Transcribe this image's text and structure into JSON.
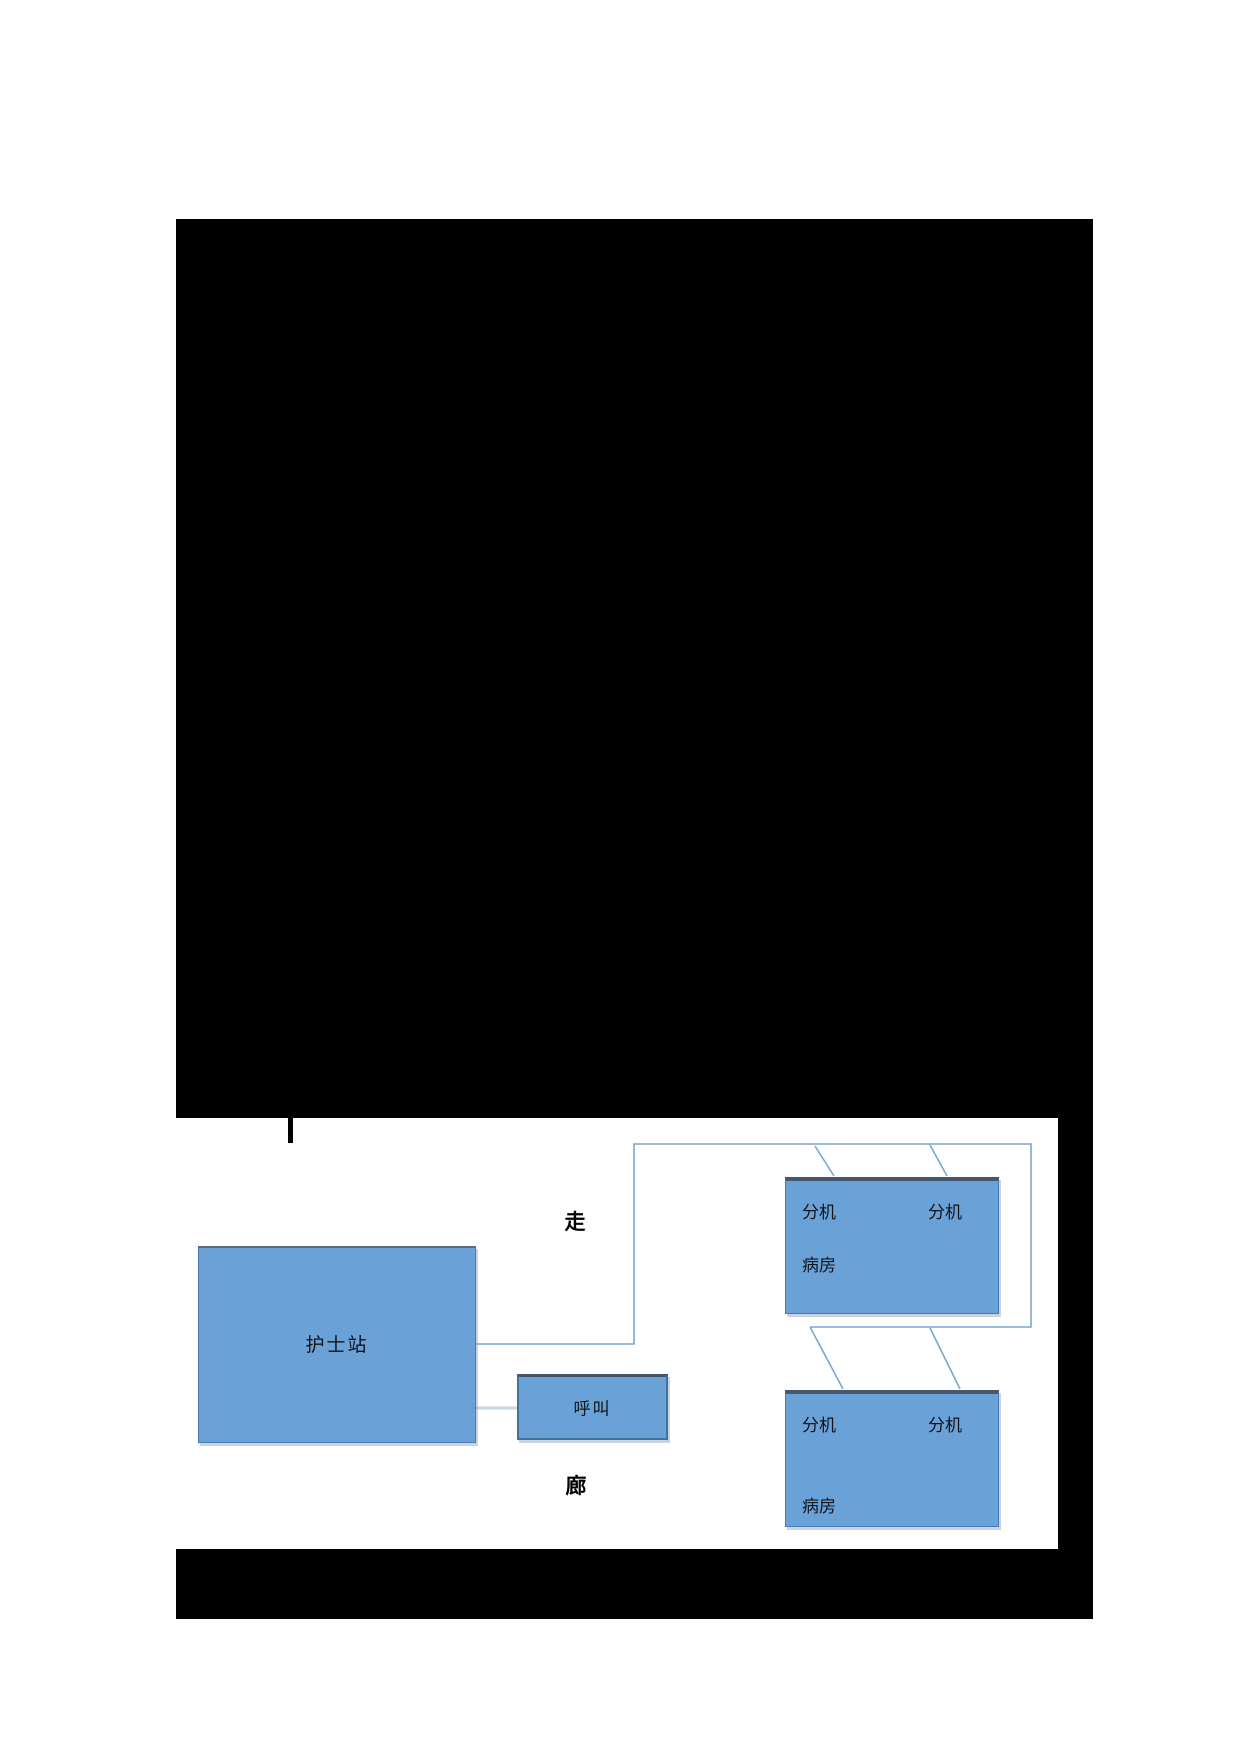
{
  "page": {
    "background_color": "#ffffff",
    "redaction_color": "#000000"
  },
  "diagram": {
    "title_hint": "nurse-call-system-layout",
    "corridor": {
      "char_top": "走",
      "char_bottom": "廊"
    },
    "nurse_station": {
      "label": "护士站"
    },
    "call_button": {
      "label": "呼叫"
    },
    "wards": [
      {
        "extensions": [
          "分机",
          "分机"
        ],
        "room": "病房"
      },
      {
        "extensions": [
          "分机",
          "分机"
        ],
        "room": "病房"
      }
    ],
    "colors": {
      "box_fill": "#6aa2d8",
      "box_border": "#4a7ab5",
      "box_border_dark": "#44546a",
      "connector": "#7aa7cf",
      "connector_light": "#c6d7e9",
      "text": "#10141c"
    }
  }
}
